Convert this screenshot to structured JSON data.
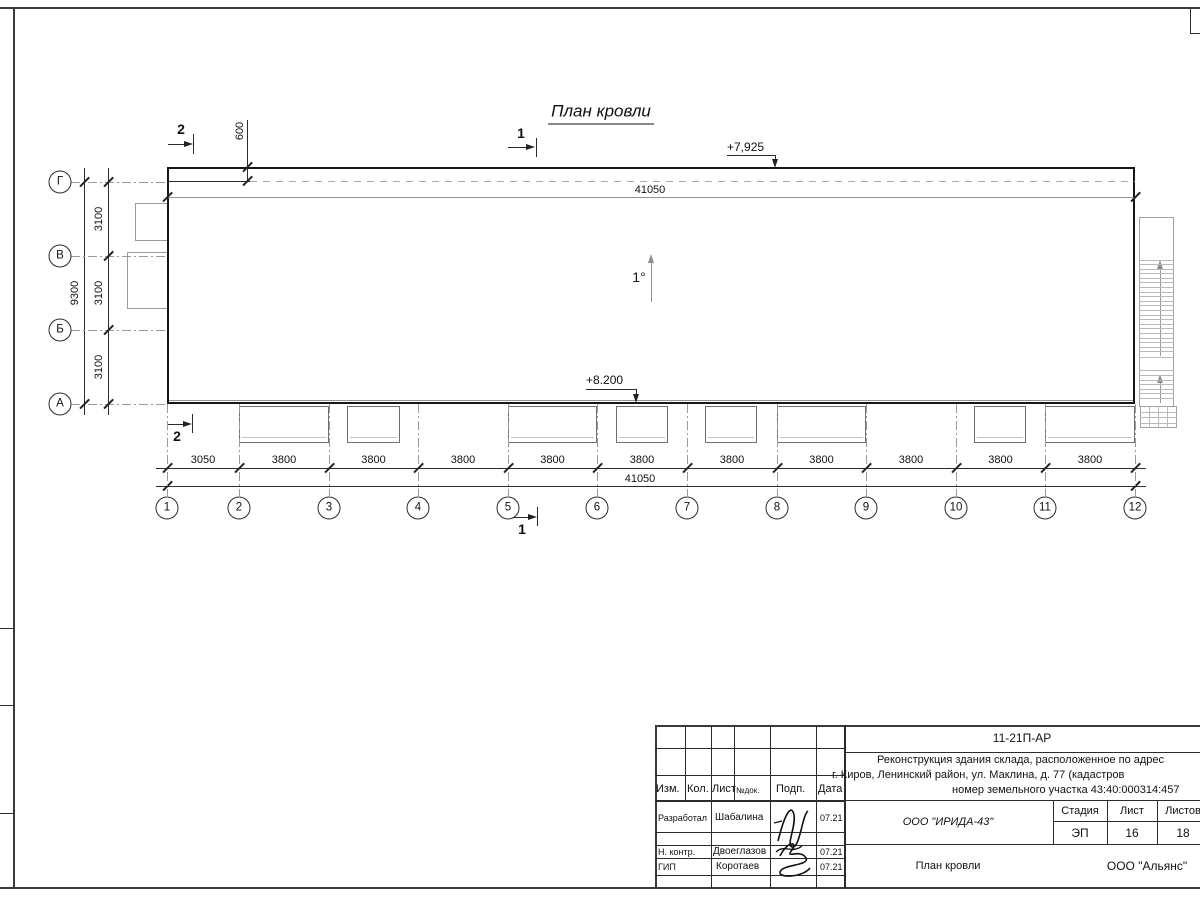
{
  "drawing": {
    "title": "План кровли",
    "slope_label": "1°",
    "elevation_top": "+7,925",
    "elevation_bottom": "+8.200",
    "dim_top_offset": "600",
    "dim_top_total": "41050",
    "dim_bottom_total": "41050",
    "dim_bottom_segments": [
      "3050",
      "3800",
      "3800",
      "3800",
      "3800",
      "3800",
      "3800",
      "3800",
      "3800",
      "3800",
      "3800"
    ],
    "dim_left_total": "9300",
    "dim_left_segments": [
      "3100",
      "3100",
      "3100"
    ],
    "axes_bottom": [
      "1",
      "2",
      "3",
      "4",
      "5",
      "6",
      "7",
      "8",
      "9",
      "10",
      "11",
      "12"
    ],
    "axes_left": [
      "Г",
      "В",
      "Б",
      "А"
    ],
    "section_mark_1": "1",
    "section_mark_2": "2"
  },
  "titleblock": {
    "doc_number": "11-21П-АР",
    "project_line1": "Реконструкция здания склада, расположенное по адрес",
    "project_line2": "г. Киров, Ленинский район, ул. Маклина, д. 77 (кадастров",
    "project_line3": "номер земельного участка 43:40:000314:457",
    "col_izm": "Изм.",
    "col_kol": "Кол.",
    "col_list": "Лист",
    "col_ndok": "№док.",
    "col_podp": "Подп.",
    "col_data": "Дата",
    "row1_role": "Разработал",
    "row1_name": "Шабалина",
    "row1_date": "07.21",
    "row2_role": "Н. контр.",
    "row2_name": "Двоеглазов",
    "row2_date": "07.21",
    "row3_role": "ГИП",
    "row3_name": "Коротаев",
    "row3_date": "07.21",
    "org": "ООО \"ИРИДА-43\"",
    "sheet_name": "План кровли",
    "company": "ООО \"Альянс\"",
    "stage_label": "Стадия",
    "list_label": "Лист",
    "listov_label": "Листов",
    "stage_value": "ЭП",
    "list_value": "16",
    "listov_value": "18"
  }
}
